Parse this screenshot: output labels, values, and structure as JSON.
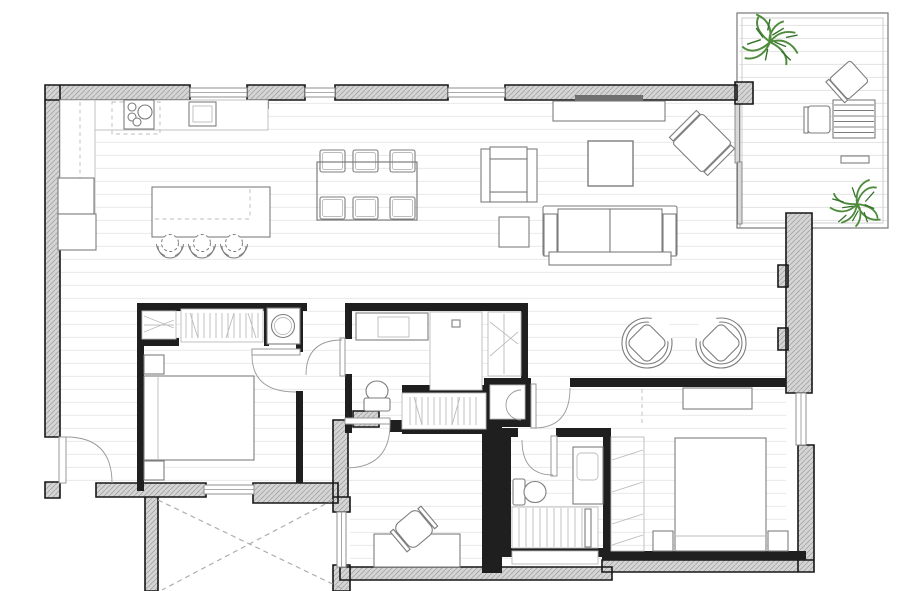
{
  "plan": {
    "title": "Two-bedroom apartment floor plan with corner terrace",
    "drawing_type": "architectural floor plan, top-down view, no text labels"
  },
  "colors": {
    "bg": "#ffffff",
    "wall_fill": "#d5d5d5",
    "wall_hatch": "#a6a6a6",
    "wall_stroke": "#161616",
    "partition": "#1f1f1f",
    "plank": "#e9e9e9",
    "deck": "#e3e3e3",
    "furniture": "#7d7d7d",
    "furniture_light": "#bcbcbc",
    "door": "#999999",
    "dash": "#aeaeae",
    "glass": "#8f8f8f",
    "plant": "#4e8c3c",
    "plant_dark": "#34702b",
    "tv": "#6f6f6f"
  },
  "rooms": [
    {
      "id": "kitchen",
      "furniture": [
        "wall counter",
        "cooktop with 4 burners",
        "extractor hood (dashed)",
        "sink",
        "tall cabinet column",
        "island",
        "3 bar stools"
      ]
    },
    {
      "id": "dining-area",
      "furniture": [
        "dining table",
        "6 chairs"
      ]
    },
    {
      "id": "living-room",
      "furniture": [
        "tv sideboard",
        "tv",
        "armchair",
        "side table",
        "coffee table",
        "3-seat sofa",
        "diagonal accent chair"
      ]
    },
    {
      "id": "terrace",
      "furniture": [
        "2 plants",
        "slatted outdoor table",
        "2 outdoor chairs",
        "bench",
        "sliding glass door"
      ]
    },
    {
      "id": "entry-hall",
      "furniture": [
        "entry door with swing"
      ]
    },
    {
      "id": "bedroom-1",
      "furniture": [
        "double bed",
        "2 nightstands",
        "open wardrobe",
        "shelf unit",
        "washing machine"
      ]
    },
    {
      "id": "bathroom-1",
      "furniture": [
        "vanity with sink",
        "walk-in shower with drain",
        "toilet",
        "storage cabinet"
      ]
    },
    {
      "id": "dressing-hallway",
      "furniture": [
        "open wardrobe",
        "storage closet"
      ]
    },
    {
      "id": "study",
      "furniture": [
        "desk",
        "swivel chair"
      ]
    },
    {
      "id": "bathroom-2",
      "furniture": [
        "tall vanity with sink",
        "toilet",
        "slatted shower",
        "shelf"
      ]
    },
    {
      "id": "sitting-area",
      "furniture": [
        "2 round lounge chairs"
      ]
    },
    {
      "id": "bedroom-2",
      "furniture": [
        "double bed",
        "2 nightstands",
        "dresser",
        "open wardrobe"
      ]
    },
    {
      "id": "lightwell",
      "furniture": [
        "dashed X void marking"
      ]
    }
  ],
  "counts": {
    "bedrooms": 2,
    "bathrooms": 2,
    "dining_chairs": 6,
    "bar_stools": 3,
    "lounge_chairs": 2,
    "plants": 2,
    "door_swings": 6,
    "windows": 6
  }
}
